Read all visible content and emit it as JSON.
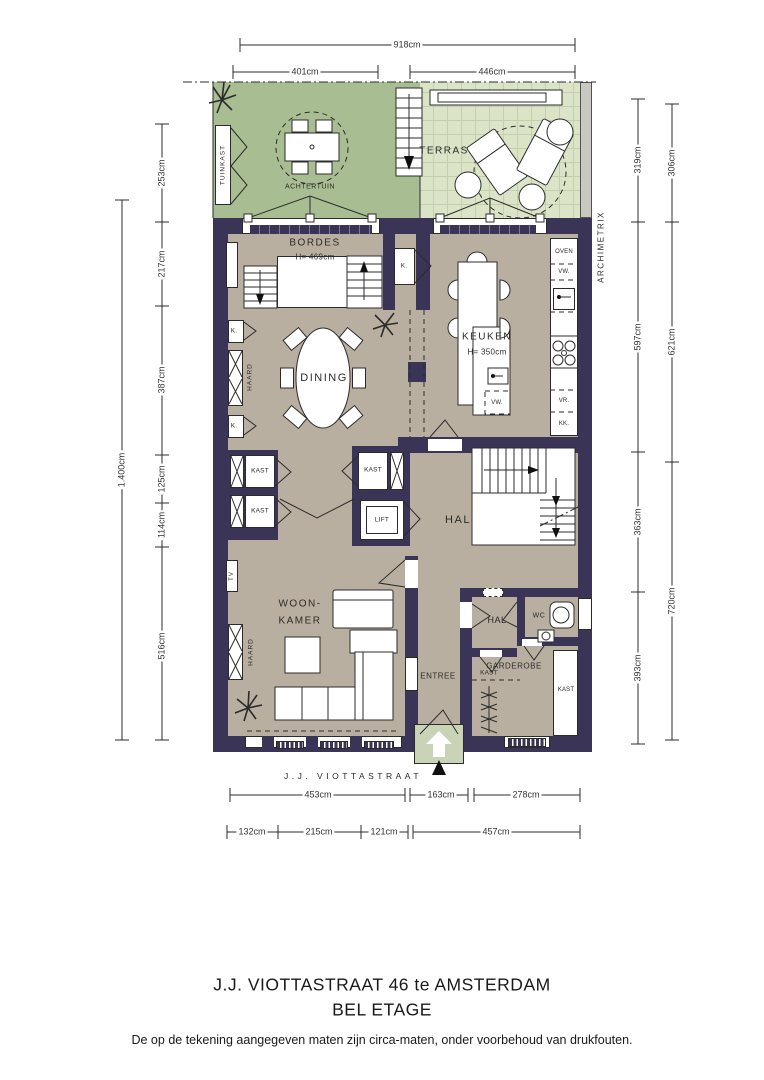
{
  "meta": {
    "title_line1": "J.J. VIOTTASTRAAT 46 te AMSTERDAM",
    "title_line2": "BEL ETAGE",
    "disclaimer": "De op de tekening aangegeven maten zijn circa-maten, onder voorbehoud van drukfouten.",
    "street": "J.J. VIOTTASTRAAT",
    "watermark": "ARCHIMETRIX"
  },
  "rooms": {
    "achtertuin": "ACHTERTUIN",
    "terras": "TERRAS",
    "bordes": "BORDES",
    "bordes_h": "H= 469cm",
    "keuken": "KEUKEN",
    "keuken_h": "H= 350cm",
    "dining": "DINING",
    "hal": "HAL",
    "hal_klein": "HAL",
    "lift": "LIFT",
    "woonkamer_1": "WOON-",
    "woonkamer_2": "KAMER",
    "entree": "ENTREE",
    "garderobe": "GARDEROBE",
    "wc": "WC"
  },
  "fixtures": {
    "tuinkast": "TUINKAST",
    "haard": "HAARD",
    "kast": "KAST",
    "k": "K.",
    "tv": "TV",
    "oven": "OVEN",
    "vw": "VW.",
    "vr": "VR.",
    "kk": "KK."
  },
  "dims": {
    "d918": "918cm",
    "d401": "401cm",
    "d446": "446cm",
    "d253": "253cm",
    "d217": "217cm",
    "d387": "387cm",
    "d125": "125cm",
    "d114": "114cm",
    "d516": "516cm",
    "d1400": "1.400cm",
    "d319": "319cm",
    "d306": "306cm",
    "d597": "597cm",
    "d621": "621cm",
    "d363": "363cm",
    "d720": "720cm",
    "d393": "393cm",
    "d453": "453cm",
    "d163": "163cm",
    "d278": "278cm",
    "d132": "132cm",
    "d215": "215cm",
    "d121": "121cm",
    "d457": "457cm"
  },
  "colors": {
    "wall": "#3a3457",
    "floor": "#b8afa0",
    "garden": "#a9bd92",
    "terrace": "#dce4c8",
    "terrace_grid": "#c3cfad",
    "stoop": "#c9d4b6",
    "line": "#2b2b2b",
    "paper": "#ffffff"
  }
}
